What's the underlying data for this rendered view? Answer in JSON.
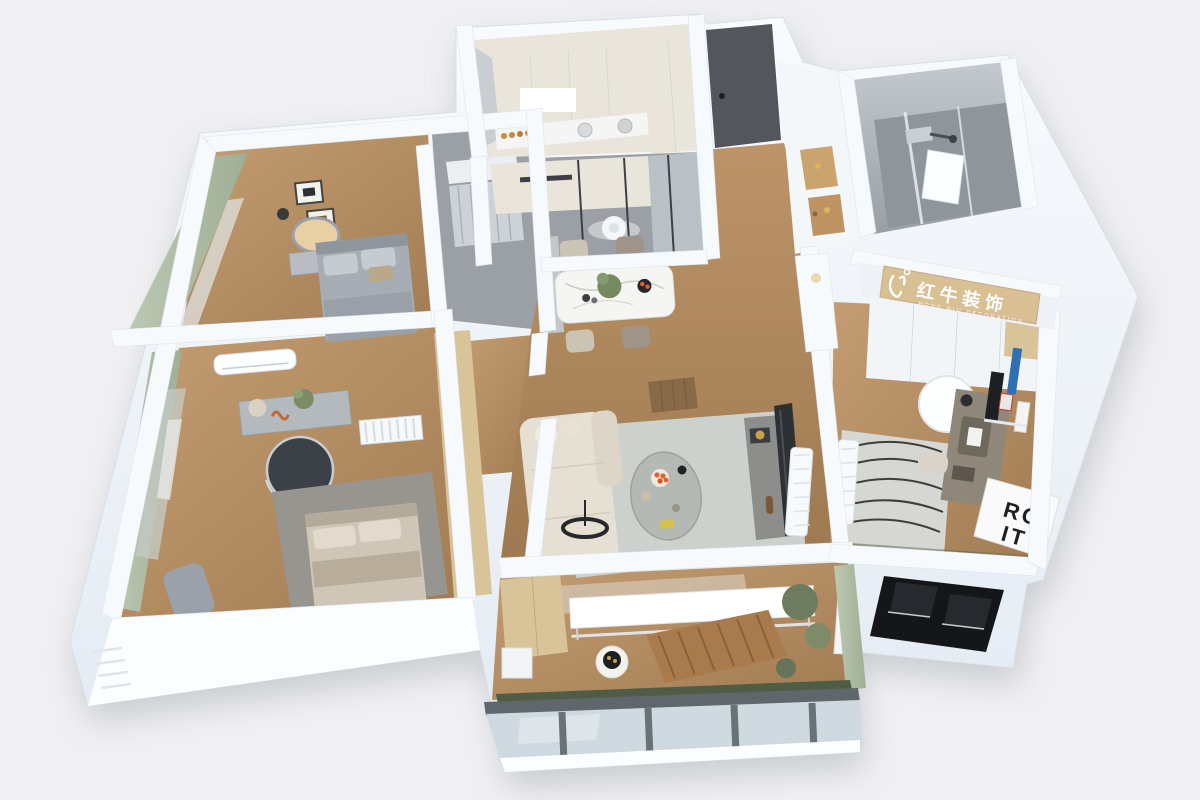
{
  "meta": {
    "description": "3D isometric rendering of an apartment floor plan, viewed from above",
    "background": "#f0f0f2"
  },
  "branding": {
    "logo_cn": "红牛装饰",
    "logo_en": "HONG NIU DECORATION",
    "sign_bg": "#d8bf94",
    "text_color": "#ffffff"
  },
  "poster": {
    "line1": "RO",
    "line2": "IT"
  },
  "palette": {
    "background": "#f0f0f2",
    "wall_top": "#f7fafc",
    "wall_face": "#e9eff6",
    "wall_edge": "#dde4ec",
    "wall_bright": "#fbfdff",
    "floor_wood": "#b8906a",
    "floor_wood_dark": "#9c7850",
    "floor_gray": "#9aa0a5",
    "bath_tile": "#aab1b7",
    "rug_living": "#ccd1cd",
    "rug_master": "#97958f",
    "rug_study": "#d6d6d2",
    "sofa": "#e6e0d4",
    "bed_master": "#cfc6b7",
    "bed_guest": "#a7adb5",
    "curtain": "#b3c0a8",
    "door_dark": "#53575d",
    "cabinet_cream": "#e9e5da",
    "wood_furniture": "#d9c499",
    "glass": "#cfd9e0",
    "frame_dark": "#5f666c",
    "plant_green": "#6d7c5e",
    "accent_orange": "#e2622f",
    "black": "#141619"
  }
}
